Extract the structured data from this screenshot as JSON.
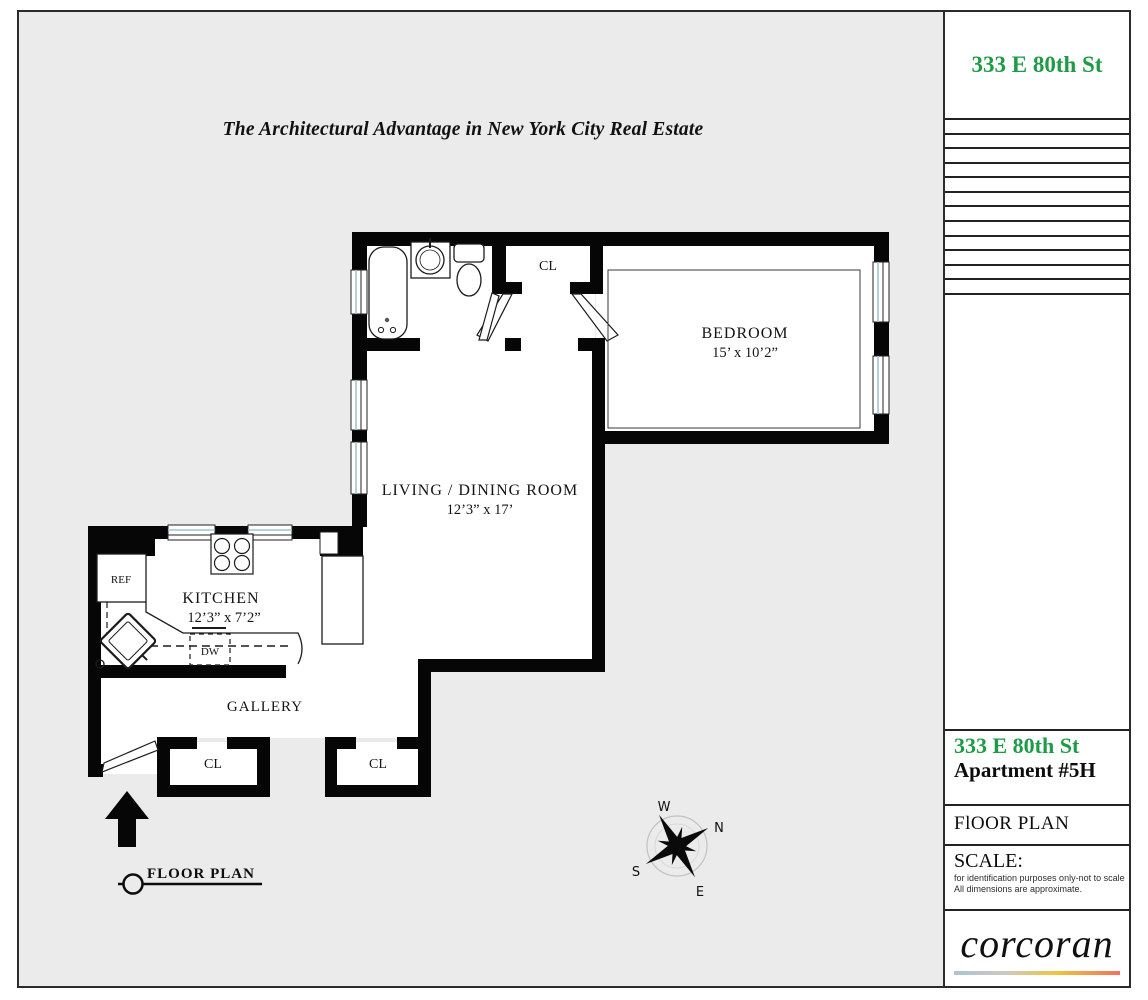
{
  "header": {
    "title": "The Architectural Advantage in New York City Real Estate"
  },
  "sidebar": {
    "top_address": "333 E 80th St",
    "address": "333 E 80th St",
    "apartment": "Apartment #5H",
    "section_label": "FlOOR PLAN",
    "scale_label": "SCALE:",
    "scale_note_line1": "for identification purposes only-not to scale",
    "scale_note_line2": "All dimensions are approximate.",
    "brand_name": "corcoran",
    "accent_green": "#1e9b47"
  },
  "plan": {
    "rooms": [
      {
        "name": "BEDROOM",
        "dims": "15’ x 10’2”"
      },
      {
        "name": "LIVING / DINING ROOM",
        "dims": "12’3” x 17’"
      },
      {
        "name": "KITCHEN",
        "dims": "12’3” x 7’2”"
      },
      {
        "name": "GALLERY",
        "dims": ""
      }
    ],
    "closet_label": "CL",
    "fixtures": {
      "refrigerator": "REF",
      "dishwasher": "DW"
    },
    "legend_label": "FLOOR PLAN",
    "compass": {
      "north": "N",
      "south": "S",
      "east": "E",
      "west": "W"
    }
  }
}
